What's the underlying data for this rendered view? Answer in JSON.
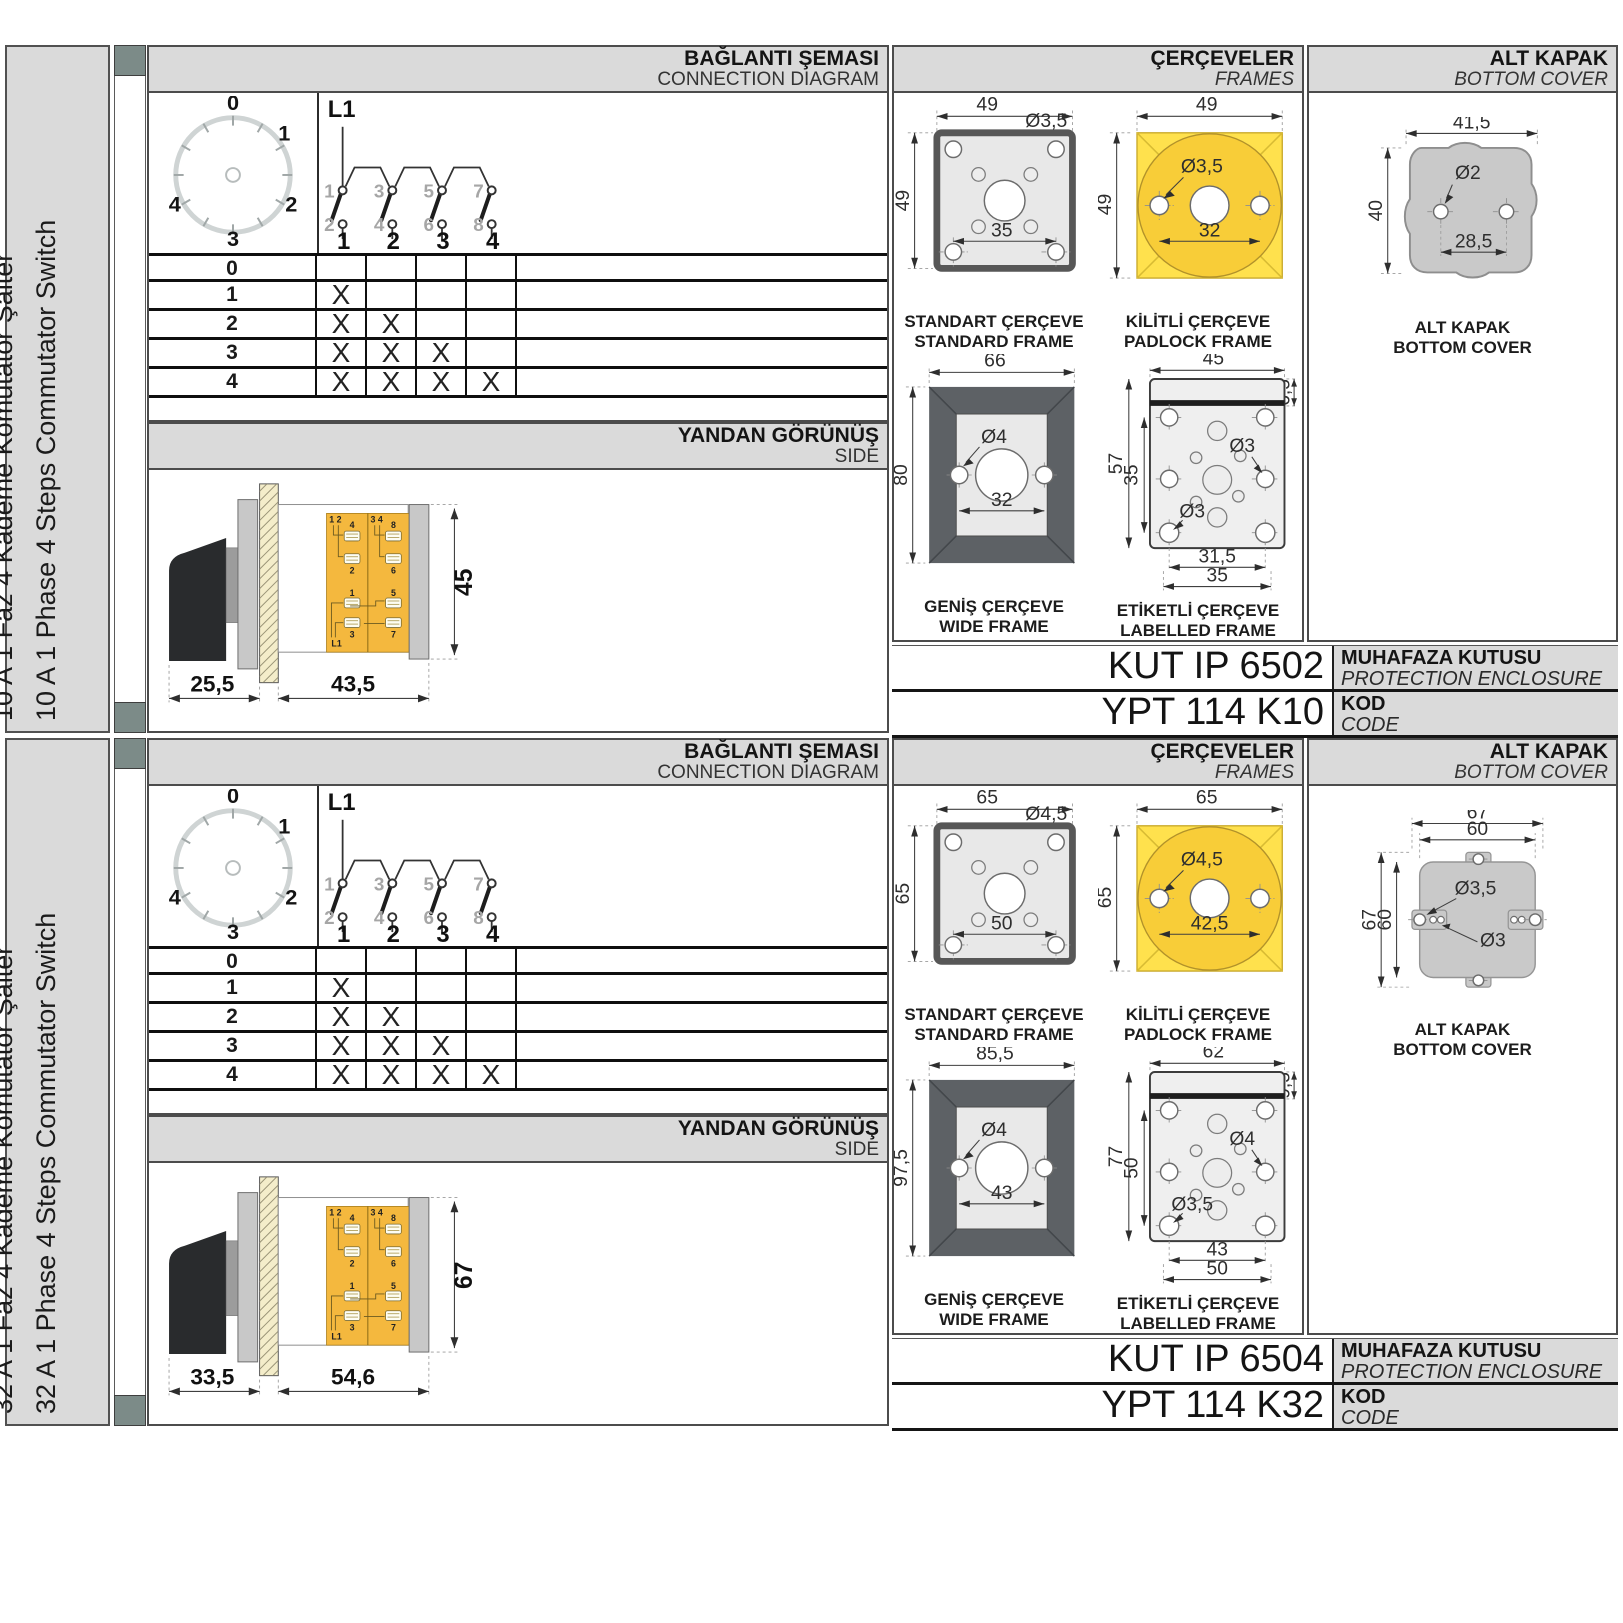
{
  "shared": {
    "headers": {
      "connection_tr": "BAĞLANTI ŞEMASI",
      "connection_en": "CONNECTION DIAGRAM",
      "side_tr": "YANDAN GÖRÜNÜŞ",
      "side_en": "SIDE",
      "frames_tr": "ÇERÇEVELER",
      "frames_en": "FRAMES",
      "cover_tr": "ALT KAPAK",
      "cover_en": "BOTTOM COVER"
    },
    "dial": {
      "labels": [
        "0",
        "1",
        "2",
        "3",
        "4"
      ]
    },
    "schematic": {
      "input": "L1",
      "top_terminals": [
        "1",
        "3",
        "5",
        "7"
      ],
      "bottom_terminals": [
        "2",
        "4",
        "6",
        "8"
      ],
      "outputs": [
        "1",
        "2",
        "3",
        "4"
      ]
    },
    "truth_table": {
      "rows": [
        {
          "step": "0",
          "cells": [
            "",
            "",
            "",
            ""
          ]
        },
        {
          "step": "1",
          "cells": [
            "X",
            "",
            "",
            ""
          ]
        },
        {
          "step": "2",
          "cells": [
            "X",
            "X",
            "",
            ""
          ]
        },
        {
          "step": "3",
          "cells": [
            "X",
            "X",
            "X",
            ""
          ]
        },
        {
          "step": "4",
          "cells": [
            "X",
            "X",
            "X",
            "X"
          ]
        }
      ]
    },
    "terminal_block": {
      "pair_left": "1 2",
      "pair_right": "3 4",
      "lugs_left": [
        "4",
        "2",
        "1",
        "3"
      ],
      "lugs_right": [
        "8",
        "6",
        "5",
        "7"
      ],
      "input": "L1"
    },
    "frame_captions": {
      "standard_tr": "STANDART ÇERÇEVE",
      "standard_en": "STANDARD FRAME",
      "padlock_tr": "KİLİTLİ ÇERÇEVE",
      "padlock_en": "PADLOCK FRAME",
      "wide_tr": "GENİŞ ÇERÇEVE",
      "wide_en": "WIDE FRAME",
      "labelled_tr": "ETİKETLİ ÇERÇEVE",
      "labelled_en": "LABELLED FRAME"
    },
    "cover_caption_tr": "ALT KAPAK",
    "cover_caption_en": "BOTTOM COVER",
    "enclosure_label_tr": "MUHAFAZA KUTUSU",
    "enclosure_label_en": "PROTECTION ENCLOSURE",
    "code_label_tr": "KOD",
    "code_label_en": "CODE",
    "colors": {
      "panel_gray": "#dadada",
      "padlock_frame_yellow": "#ffe14d",
      "padlock_circle_yellow": "#f8cd38",
      "terminal_block_orange": "#f4b83e",
      "wide_frame_dark": "#5d6165",
      "cover_gray": "#c9c9c9",
      "spine_slate": "#7c8b88"
    }
  },
  "products": [
    {
      "sidebar_title_tr": "10 A 1 Faz 4 Kademe Komütatör Şalter",
      "sidebar_title_en": "10 A 1 Phase 4 Steps Commutator Switch",
      "side_view": {
        "handle_length": "25,5",
        "body_length": "43,5",
        "height": "45"
      },
      "standard_frame": {
        "width": "49",
        "height": "49",
        "hole": "Ø3,5",
        "hole_spacing": "35"
      },
      "padlock_frame": {
        "width": "49",
        "height": "49",
        "hole": "Ø3,5",
        "hole_spacing": "32"
      },
      "wide_frame": {
        "width": "66",
        "height": "80",
        "hole": "Ø4",
        "hole_spacing": "32"
      },
      "labelled_frame": {
        "width": "45",
        "strip": "6,5",
        "height": "57",
        "hole_height": "35",
        "hole_right": "Ø3",
        "hole_left": "Ø3",
        "spacing_inner": "31,5",
        "spacing_outer": "35"
      },
      "bottom_cover": {
        "variant": "blob",
        "width": "41,5",
        "height": "40",
        "hole": "Ø2",
        "hole_spacing": "28,5"
      },
      "enclosure_code": "KUT IP 6502",
      "product_code": "YPT 114 K10"
    },
    {
      "sidebar_title_tr": "32 A 1 Faz 4 Kademe Komütatör Şalter",
      "sidebar_title_en": "32 A 1 Phase 4 Steps Commutator Switch",
      "side_view": {
        "handle_length": "33,5",
        "body_length": "54,6",
        "height": "67"
      },
      "standard_frame": {
        "width": "65",
        "height": "65",
        "hole": "Ø4,5",
        "hole_spacing": "50"
      },
      "padlock_frame": {
        "width": "65",
        "height": "65",
        "hole": "Ø4,5",
        "hole_spacing": "42,5"
      },
      "wide_frame": {
        "width": "85,5",
        "height": "97,5",
        "hole": "Ø4",
        "hole_spacing": "43"
      },
      "labelled_frame": {
        "width": "62",
        "strip": "9,5",
        "height": "77",
        "hole_height": "50",
        "hole_right": "Ø4",
        "hole_left": "Ø3,5",
        "spacing_inner": "43",
        "spacing_outer": "50"
      },
      "bottom_cover": {
        "variant": "tabs",
        "width_outer": "67",
        "width_inner": "60",
        "height_outer": "67",
        "height_inner": "60",
        "hole_tab": "Ø3,5",
        "hole_small": "Ø3"
      },
      "enclosure_code": "KUT IP 6504",
      "product_code": "YPT 114 K32"
    }
  ]
}
